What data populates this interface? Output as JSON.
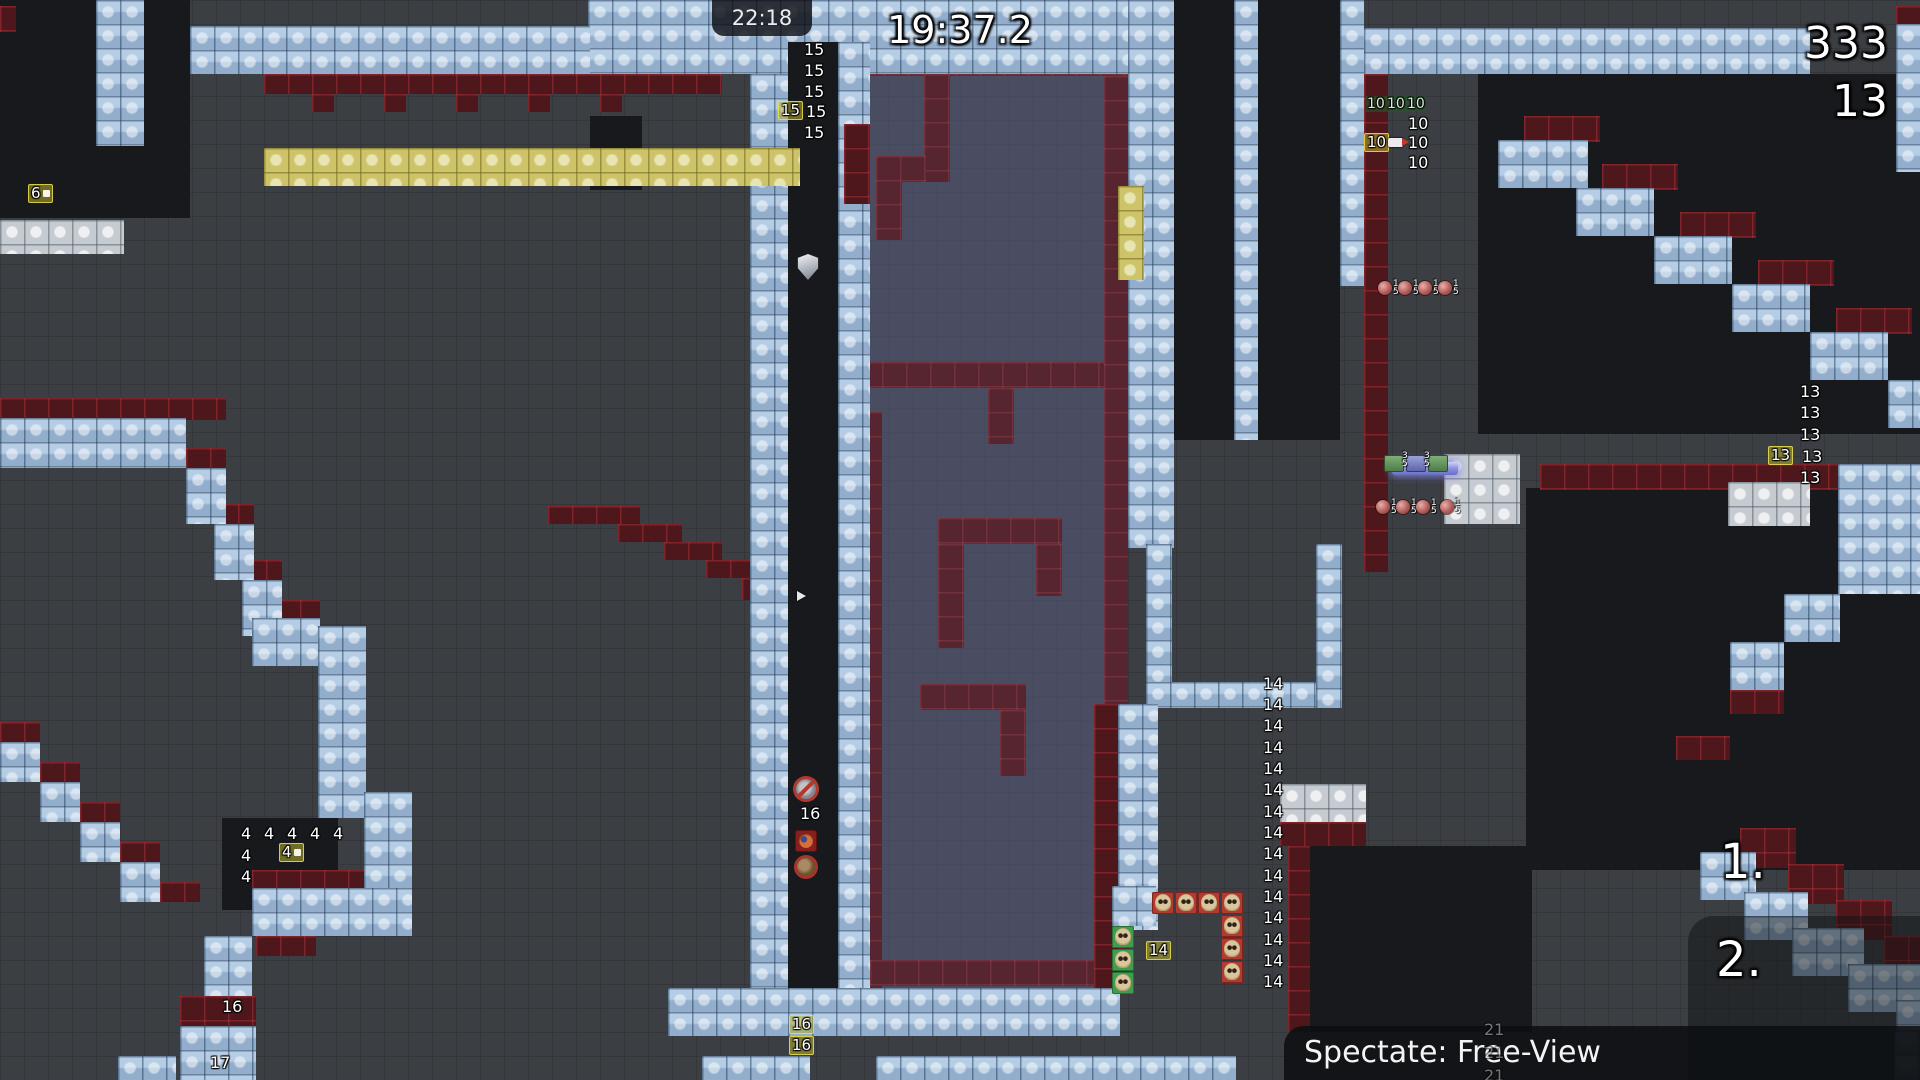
{
  "hud": {
    "clock_label": "22:18",
    "race_timer": "19:37.2",
    "score_big": "333",
    "score_small": "13",
    "rank_first": "1.",
    "rank_second": "2.",
    "spectate_label": "Spectate: Free-View"
  },
  "colors": {
    "background": "#3b3e42",
    "tile_blue": "#a7c3e0",
    "tile_red": "#4e171c",
    "tile_yellow": "#cdc46a",
    "tile_grey": "#c6cbd1",
    "freeze_purple": "rgba(88,92,128,0.52)",
    "badge_yellow": "rgba(186,176,44,0.55)",
    "badge_green": "rgba(34,88,40,0.6)",
    "hud_text": "#ffffff"
  },
  "map": {
    "blocks": [
      [
        "p",
        870,
        76,
        258,
        912
      ],
      [
        "k",
        0,
        0,
        190,
        218
      ],
      [
        "k",
        590,
        116,
        52,
        74
      ],
      [
        "k",
        1174,
        0,
        60,
        440
      ],
      [
        "k",
        1258,
        0,
        82,
        440
      ],
      [
        "k",
        1478,
        74,
        442,
        360
      ],
      [
        "k",
        1526,
        488,
        394,
        382
      ],
      [
        "k",
        222,
        818,
        116,
        92
      ],
      [
        "k",
        1296,
        846,
        236,
        186
      ],
      [
        "rm",
        860,
        50,
        268,
        26
      ],
      [
        "rm",
        924,
        50,
        26,
        132
      ],
      [
        "rm",
        876,
        156,
        50,
        26
      ],
      [
        "rm",
        876,
        156,
        26,
        84
      ],
      [
        "rm",
        1104,
        76,
        24,
        912
      ],
      [
        "rm",
        864,
        412,
        18,
        576
      ],
      [
        "rm",
        858,
        362,
        246,
        26
      ],
      [
        "rm",
        988,
        388,
        26,
        56
      ],
      [
        "rm",
        938,
        518,
        124,
        26
      ],
      [
        "rm",
        1036,
        544,
        26,
        52
      ],
      [
        "rm",
        938,
        544,
        26,
        104
      ],
      [
        "rm",
        920,
        684,
        106,
        26
      ],
      [
        "rm",
        1000,
        710,
        26,
        66
      ],
      [
        "rm",
        870,
        960,
        234,
        26
      ],
      [
        "r",
        0,
        6,
        16,
        26
      ],
      [
        "r",
        264,
        74,
        458,
        20
      ],
      [
        "r",
        312,
        94,
        22,
        18
      ],
      [
        "r",
        384,
        94,
        22,
        18
      ],
      [
        "r",
        456,
        94,
        22,
        18
      ],
      [
        "r",
        528,
        94,
        22,
        18
      ],
      [
        "r",
        600,
        94,
        22,
        18
      ],
      [
        "r",
        1896,
        6,
        24,
        18
      ],
      [
        "r",
        0,
        398,
        226,
        22
      ],
      [
        "r",
        186,
        448,
        40,
        20
      ],
      [
        "r",
        214,
        504,
        40,
        20
      ],
      [
        "r",
        242,
        560,
        40,
        20
      ],
      [
        "r",
        548,
        506,
        92,
        18
      ],
      [
        "r",
        618,
        524,
        64,
        18
      ],
      [
        "r",
        664,
        542,
        58,
        18
      ],
      [
        "r",
        706,
        560,
        52,
        18
      ],
      [
        "r",
        742,
        578,
        50,
        22
      ],
      [
        "r",
        1364,
        74,
        24,
        498
      ],
      [
        "r",
        1540,
        464,
        300,
        26
      ],
      [
        "r",
        1524,
        116,
        76,
        26
      ],
      [
        "r",
        1602,
        164,
        76,
        26
      ],
      [
        "r",
        1680,
        212,
        76,
        26
      ],
      [
        "r",
        1758,
        260,
        76,
        26
      ],
      [
        "r",
        1836,
        308,
        76,
        26
      ],
      [
        "r",
        1730,
        690,
        54,
        24
      ],
      [
        "r",
        1676,
        736,
        54,
        24
      ],
      [
        "r",
        1094,
        704,
        24,
        286
      ],
      [
        "r",
        1280,
        822,
        86,
        24
      ],
      [
        "r",
        1288,
        846,
        22,
        186
      ],
      [
        "r",
        0,
        722,
        40,
        20
      ],
      [
        "r",
        40,
        762,
        40,
        20
      ],
      [
        "r",
        80,
        802,
        40,
        20
      ],
      [
        "r",
        120,
        842,
        40,
        20
      ],
      [
        "r",
        160,
        882,
        40,
        20
      ],
      [
        "r",
        252,
        600,
        68,
        18
      ],
      [
        "r",
        252,
        870,
        160,
        18
      ],
      [
        "r",
        256,
        936,
        60,
        20
      ],
      [
        "r",
        180,
        996,
        76,
        30
      ],
      [
        "r",
        1740,
        828,
        56,
        40
      ],
      [
        "r",
        1788,
        864,
        56,
        40
      ],
      [
        "r",
        1836,
        900,
        56,
        40
      ],
      [
        "r",
        1884,
        936,
        36,
        40
      ],
      [
        "b",
        96,
        0,
        48,
        146
      ],
      [
        "b",
        588,
        0,
        586,
        74
      ],
      [
        "b",
        190,
        26,
        400,
        48
      ],
      [
        "b",
        750,
        74,
        38,
        916
      ],
      [
        "b",
        838,
        42,
        32,
        948
      ],
      [
        "b",
        1128,
        0,
        46,
        548
      ],
      [
        "b",
        1234,
        0,
        24,
        440
      ],
      [
        "b",
        1340,
        0,
        24,
        286
      ],
      [
        "b",
        1364,
        28,
        446,
        46
      ],
      [
        "b",
        1896,
        24,
        24,
        148
      ],
      [
        "b",
        1498,
        140,
        90,
        48
      ],
      [
        "b",
        1576,
        188,
        78,
        48
      ],
      [
        "b",
        1654,
        236,
        78,
        48
      ],
      [
        "b",
        1732,
        284,
        78,
        48
      ],
      [
        "b",
        1810,
        332,
        78,
        48
      ],
      [
        "b",
        1888,
        380,
        32,
        48
      ],
      [
        "b",
        1838,
        464,
        82,
        130
      ],
      [
        "b",
        1784,
        594,
        56,
        48
      ],
      [
        "b",
        1730,
        642,
        54,
        48
      ],
      [
        "b",
        1146,
        544,
        26,
        164
      ],
      [
        "b",
        1146,
        682,
        196,
        26
      ],
      [
        "b",
        1316,
        544,
        26,
        164
      ],
      [
        "b",
        1118,
        704,
        40,
        226
      ],
      [
        "b",
        1112,
        886,
        44,
        40
      ],
      [
        "b",
        668,
        988,
        452,
        48
      ],
      [
        "b",
        702,
        1056,
        108,
        24
      ],
      [
        "b",
        876,
        1056,
        360,
        24
      ],
      [
        "b",
        0,
        418,
        186,
        50
      ],
      [
        "b",
        186,
        468,
        40,
        56
      ],
      [
        "b",
        214,
        524,
        40,
        56
      ],
      [
        "b",
        242,
        580,
        40,
        56
      ],
      [
        "b",
        252,
        618,
        68,
        48
      ],
      [
        "b",
        318,
        626,
        48,
        192
      ],
      [
        "b",
        364,
        792,
        48,
        96
      ],
      [
        "b",
        252,
        888,
        160,
        48
      ],
      [
        "b",
        0,
        742,
        40,
        40
      ],
      [
        "b",
        40,
        782,
        40,
        40
      ],
      [
        "b",
        80,
        822,
        40,
        40
      ],
      [
        "b",
        120,
        862,
        40,
        40
      ],
      [
        "b",
        204,
        936,
        48,
        60
      ],
      [
        "b",
        180,
        1026,
        76,
        54
      ],
      [
        "b",
        118,
        1056,
        58,
        24
      ],
      [
        "b",
        1700,
        852,
        56,
        48
      ],
      [
        "b",
        1744,
        892,
        64,
        48
      ],
      [
        "b",
        1792,
        928,
        72,
        48
      ],
      [
        "b",
        1848,
        964,
        72,
        48
      ],
      [
        "b",
        1896,
        1000,
        24,
        56
      ],
      [
        "b",
        1894,
        1030,
        26,
        50
      ],
      [
        "k",
        788,
        42,
        50,
        946
      ],
      [
        "r",
        844,
        124,
        26,
        80
      ],
      [
        "y",
        264,
        148,
        536,
        38
      ],
      [
        "y",
        1118,
        186,
        26,
        94
      ],
      [
        "w",
        0,
        220,
        124,
        34
      ],
      [
        "w",
        1444,
        454,
        76,
        70
      ],
      [
        "w",
        1280,
        784,
        86,
        38
      ],
      [
        "w",
        1728,
        482,
        82,
        44
      ],
      [
        "beam",
        1392,
        462,
        66,
        13
      ]
    ]
  },
  "markers": [
    {
      "type": "np",
      "t": "15",
      "x": 804,
      "y": 42
    },
    {
      "type": "np",
      "t": "15",
      "x": 804,
      "y": 63
    },
    {
      "type": "np",
      "t": "15",
      "x": 804,
      "y": 84
    },
    {
      "type": "npy",
      "t": "15",
      "x": 778,
      "y": 101
    },
    {
      "type": "np",
      "t": "15",
      "x": 806,
      "y": 104
    },
    {
      "type": "np",
      "t": "15",
      "x": 804,
      "y": 125
    },
    {
      "type": "np",
      "t": "13",
      "x": 1800,
      "y": 384
    },
    {
      "type": "np",
      "t": "13",
      "x": 1800,
      "y": 405
    },
    {
      "type": "np",
      "t": "13",
      "x": 1800,
      "y": 427
    },
    {
      "type": "npy",
      "t": "13",
      "x": 1768,
      "y": 446
    },
    {
      "type": "np",
      "t": "13",
      "x": 1802,
      "y": 449
    },
    {
      "type": "np",
      "t": "13",
      "x": 1800,
      "y": 470
    },
    {
      "type": "np",
      "t": "14",
      "x": 1263,
      "y": 676
    },
    {
      "type": "np",
      "t": "14",
      "x": 1263,
      "y": 697
    },
    {
      "type": "np",
      "t": "14",
      "x": 1263,
      "y": 718
    },
    {
      "type": "np",
      "t": "14",
      "x": 1263,
      "y": 740
    },
    {
      "type": "np",
      "t": "14",
      "x": 1263,
      "y": 761
    },
    {
      "type": "np",
      "t": "14",
      "x": 1263,
      "y": 782
    },
    {
      "type": "np",
      "t": "14",
      "x": 1263,
      "y": 804
    },
    {
      "type": "np",
      "t": "14",
      "x": 1263,
      "y": 825
    },
    {
      "type": "np",
      "t": "14",
      "x": 1263,
      "y": 846
    },
    {
      "type": "np",
      "t": "14",
      "x": 1263,
      "y": 868
    },
    {
      "type": "np",
      "t": "14",
      "x": 1263,
      "y": 889
    },
    {
      "type": "np",
      "t": "14",
      "x": 1263,
      "y": 910
    },
    {
      "type": "np",
      "t": "14",
      "x": 1263,
      "y": 932
    },
    {
      "type": "np",
      "t": "14",
      "x": 1263,
      "y": 953
    },
    {
      "type": "np",
      "t": "14",
      "x": 1263,
      "y": 974
    },
    {
      "type": "npg",
      "t": "10",
      "x": 1366,
      "y": 96
    },
    {
      "type": "npg",
      "t": "10",
      "x": 1386,
      "y": 96
    },
    {
      "type": "npg",
      "t": "10",
      "x": 1406,
      "y": 96
    },
    {
      "type": "np",
      "t": "10",
      "x": 1408,
      "y": 116
    },
    {
      "type": "npy",
      "t": "10",
      "x": 1364,
      "y": 133
    },
    {
      "type": "rocket",
      "x": 1388,
      "y": 138
    },
    {
      "type": "np",
      "t": "10",
      "x": 1408,
      "y": 135
    },
    {
      "type": "np",
      "t": "10",
      "x": 1408,
      "y": 155
    },
    {
      "type": "np",
      "t": "4",
      "x": 241,
      "y": 826
    },
    {
      "type": "np",
      "t": "4",
      "x": 264,
      "y": 826
    },
    {
      "type": "np",
      "t": "4",
      "x": 287,
      "y": 826
    },
    {
      "type": "np",
      "t": "4",
      "x": 310,
      "y": 826
    },
    {
      "type": "np",
      "t": "4",
      "x": 333,
      "y": 826
    },
    {
      "type": "np",
      "t": "4",
      "x": 241,
      "y": 848
    },
    {
      "type": "npyt",
      "t": "4",
      "x": 279,
      "y": 843
    },
    {
      "type": "np",
      "t": "4",
      "x": 241,
      "y": 869
    },
    {
      "type": "npyt",
      "t": "6",
      "x": 28,
      "y": 184
    },
    {
      "type": "shield",
      "x": 797,
      "y": 254
    },
    {
      "type": "arrow",
      "x": 797,
      "y": 591
    },
    {
      "type": "ico-ban",
      "x": 796,
      "y": 779
    },
    {
      "type": "np",
      "t": "16",
      "x": 800,
      "y": 806
    },
    {
      "type": "ico-tee",
      "x": 795,
      "y": 830
    },
    {
      "type": "ico-ball",
      "x": 797,
      "y": 858
    },
    {
      "type": "npy",
      "t": "16",
      "x": 789,
      "y": 1015
    },
    {
      "type": "npy",
      "t": "16",
      "x": 789,
      "y": 1036
    },
    {
      "type": "np",
      "t": "16",
      "x": 222,
      "y": 999
    },
    {
      "type": "np",
      "t": "17",
      "x": 210,
      "y": 1055
    },
    {
      "type": "npf",
      "t": "21",
      "x": 1484,
      "y": 1022
    },
    {
      "type": "npf",
      "t": "21",
      "x": 1484,
      "y": 1045
    },
    {
      "type": "npf",
      "t": "21",
      "x": 1484,
      "y": 1068
    },
    {
      "type": "npy",
      "t": "14",
      "x": 1146,
      "y": 941
    },
    {
      "type": "orb",
      "t": "1|5",
      "x": 1378,
      "y": 280
    },
    {
      "type": "orb",
      "t": "1|5",
      "x": 1398,
      "y": 280
    },
    {
      "type": "orb",
      "t": "1|5",
      "x": 1418,
      "y": 280
    },
    {
      "type": "orb",
      "t": "1|5",
      "x": 1438,
      "y": 280
    },
    {
      "type": "orb",
      "t": "1|5",
      "x": 1376,
      "y": 499
    },
    {
      "type": "orb",
      "t": "1|5",
      "x": 1396,
      "y": 499
    },
    {
      "type": "orb",
      "t": "1|5",
      "x": 1416,
      "y": 499
    },
    {
      "type": "orb",
      "t": "1|5",
      "x": 1440,
      "y": 499
    },
    {
      "type": "bi-g",
      "x": 1384,
      "y": 455
    },
    {
      "type": "bi-b",
      "x": 1406,
      "y": 455
    },
    {
      "type": "bi-g",
      "x": 1428,
      "y": 455
    },
    {
      "type": "tl",
      "t": "3|5",
      "x": 1402,
      "y": 452
    },
    {
      "type": "tl",
      "t": "3|5",
      "x": 1424,
      "y": 452
    },
    {
      "type": "sk-r",
      "x": 1152,
      "y": 892
    },
    {
      "type": "sk-r",
      "x": 1175,
      "y": 892
    },
    {
      "type": "sk-r",
      "x": 1198,
      "y": 892
    },
    {
      "type": "sk-r",
      "x": 1221,
      "y": 892
    },
    {
      "type": "sk-r",
      "x": 1221,
      "y": 915
    },
    {
      "type": "sk-r",
      "x": 1221,
      "y": 938
    },
    {
      "type": "sk-r",
      "x": 1221,
      "y": 961
    },
    {
      "type": "sk-g",
      "x": 1112,
      "y": 926
    },
    {
      "type": "sk-g",
      "x": 1112,
      "y": 949
    },
    {
      "type": "sk-g",
      "x": 1112,
      "y": 972
    }
  ]
}
